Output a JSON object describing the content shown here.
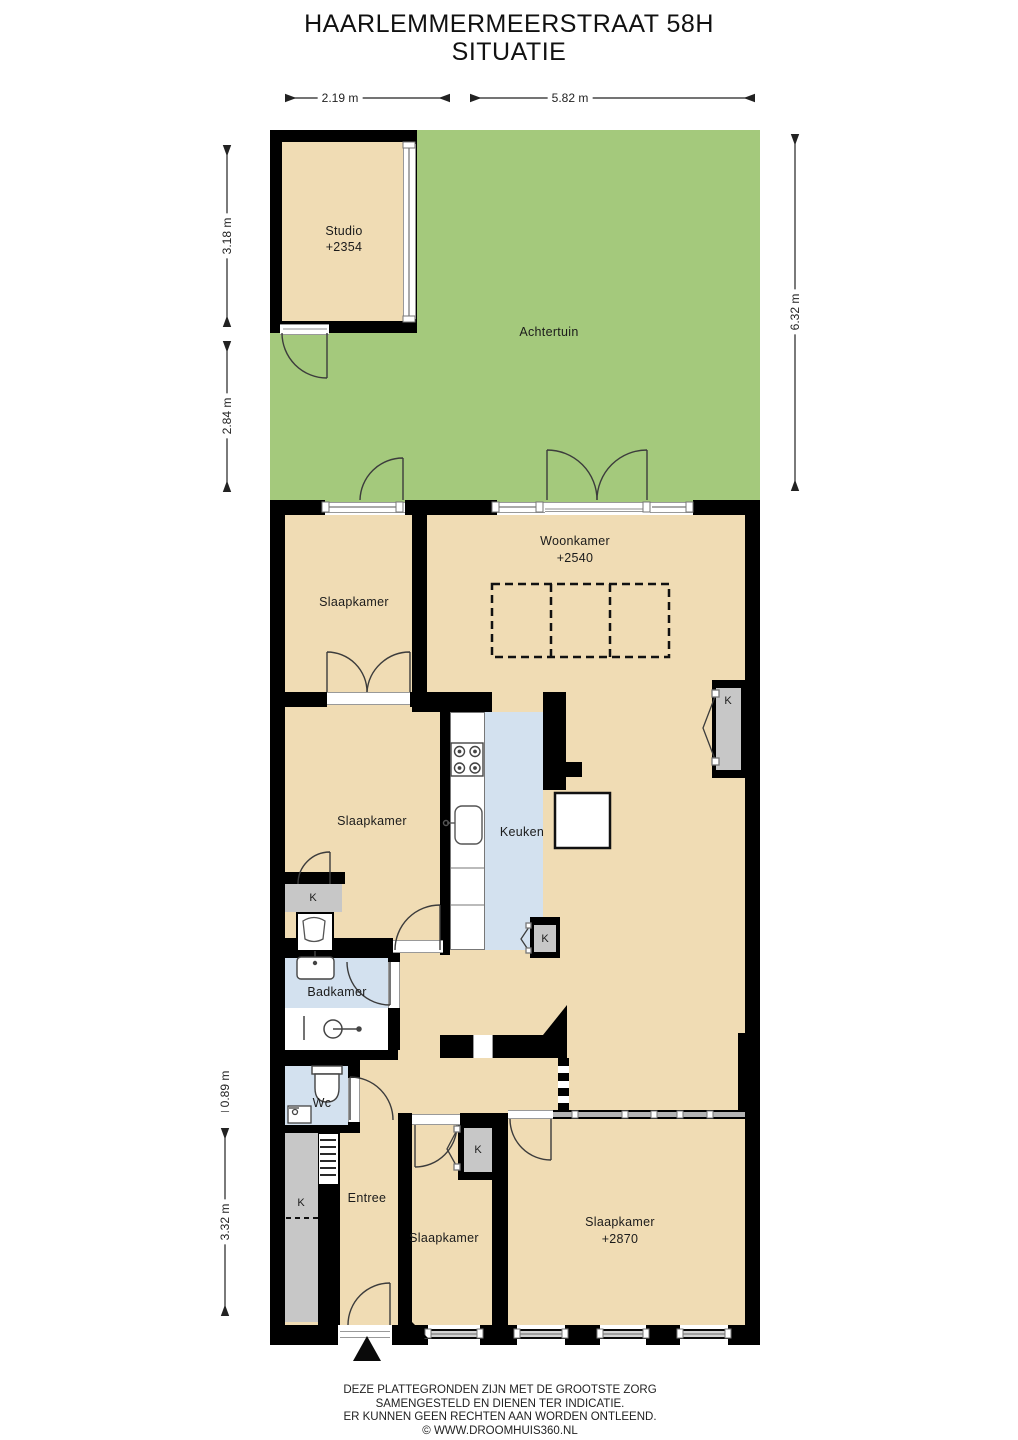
{
  "title": {
    "line1": "HAARLEMMERMEERSTRAAT 58H",
    "line2": "SITUATIE"
  },
  "dimensions": {
    "studio_width": "2.19 m",
    "garden_width": "5.82 m",
    "studio_height": "3.18 m",
    "garden_lower_height": "2.84 m",
    "garden_full_height": "6.32 m",
    "wc_height": "0.89 m",
    "front_height": "3.32 m"
  },
  "rooms": {
    "studio": {
      "name": "Studio",
      "level": "+2354"
    },
    "garden": {
      "name": "Achtertuin"
    },
    "living": {
      "name": "Woonkamer",
      "level": "+2540"
    },
    "bedroom_top": {
      "name": "Slaapkamer"
    },
    "bedroom_mid": {
      "name": "Slaapkamer"
    },
    "kitchen": {
      "name": "Keuken"
    },
    "bathroom": {
      "name": "Badkamer"
    },
    "toilet": {
      "name": "Wc"
    },
    "entry": {
      "name": "Entree"
    },
    "bedroom_small": {
      "name": "Slaapkamer"
    },
    "bedroom_right": {
      "name": "Slaapkamer",
      "level": "+2870"
    }
  },
  "closets": {
    "label": "K"
  },
  "footer": {
    "line1": "DEZE PLATTEGRONDEN ZIJN MET DE GROOTSTE ZORG",
    "line2": "SAMENGESTELD EN DIENEN TER INDICATIE.",
    "line3": "ER KUNNEN GEEN RECHTEN AAN WORDEN ONTLEEND.",
    "line4": "© WWW.DROOMHUIS360.NL"
  },
  "colors": {
    "wall": "#000000",
    "floor": "#f0dcb4",
    "garden": "#a4c97c",
    "wet_room": "#d3e1ef",
    "closet": "#c7c7c7",
    "window": "#8d8d8d"
  }
}
